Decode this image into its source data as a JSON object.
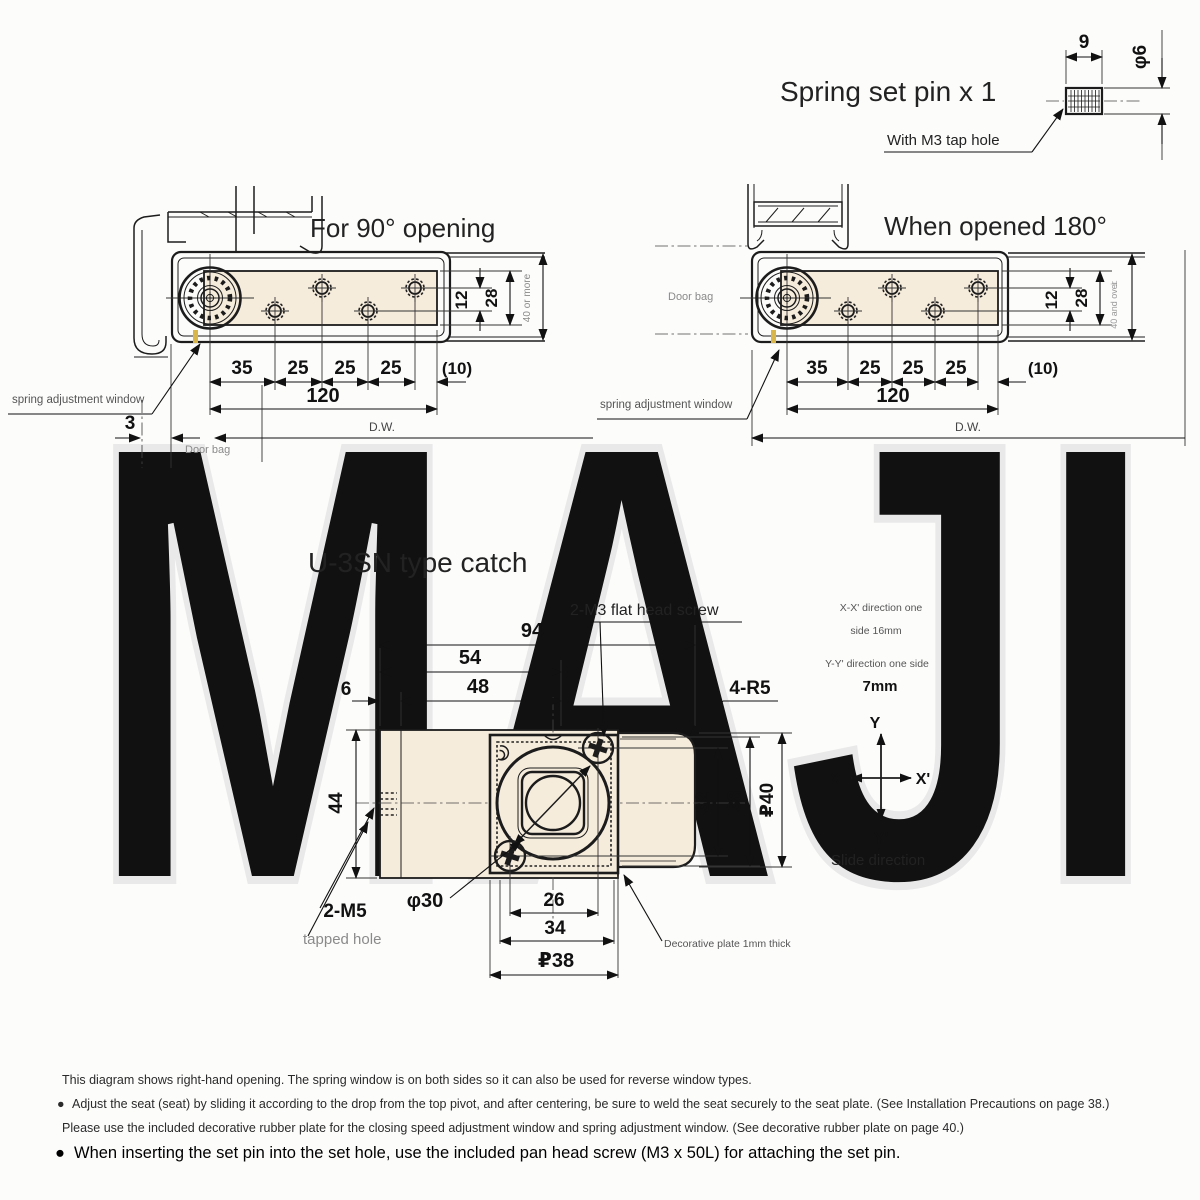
{
  "watermark": "MAJI",
  "spring_pin": {
    "title": "Spring set pin x 1",
    "note": "With M3 tap hole",
    "length": "9",
    "diameter": "φ6"
  },
  "fig_90": {
    "title": "For 90° opening",
    "chain": [
      "35",
      "25",
      "25",
      "25",
      "(10)"
    ],
    "total": "120",
    "door_width": "D.W.",
    "gap": "3",
    "door_bag": "Door bag",
    "spring_window": "spring adjustment window",
    "pitch": "12",
    "plate_width": "28",
    "clearance": "40 or more"
  },
  "fig_180": {
    "title": "When opened 180°",
    "chain": [
      "35",
      "25",
      "25",
      "25",
      "(10)"
    ],
    "total": "120",
    "door_width": "D.W.",
    "door_bag": "Door bag",
    "spring_window": "spring adjustment window",
    "pitch": "12",
    "plate_width": "28",
    "clearance": "40 and over",
    "datum_mark": "⊥"
  },
  "catch": {
    "title": "U-3SN type catch",
    "screw_label": "2-M3 flat head screw",
    "corner_radius": "4-R5",
    "w94": "94",
    "w54": "54",
    "w48": "48",
    "w6": "6",
    "h44": "44",
    "h32": "32",
    "h38": "38",
    "h40": "₽40",
    "dia30": "φ30",
    "w26": "26",
    "w34": "34",
    "w38": "₽38",
    "tap": "2-M5",
    "tap_note": "tapped hole",
    "plate_note": "Decorative plate 1mm thick",
    "xx_note_line1": "X-X' direction one",
    "xx_note_line2": "side 16mm",
    "yy_note_line1": "Y-Y' direction one side",
    "yy_note_line2": "7mm",
    "axis_y": "Y",
    "axis_x": "X",
    "axis_x_prime": "X'",
    "axis_y_prime": "Y'",
    "slide_direction": "Slide direction"
  },
  "notes": {
    "bullet": "●",
    "line1": "This diagram shows right-hand opening. The spring window is on both sides so it can also be used for reverse window types.",
    "line2": "Adjust the seat (seat) by sliding it according to the drop from the top pivot, and after centering, be sure to weld the seat securely to the seat plate. (See Installation Precautions on page 38.)",
    "line3": "Please use the included decorative rubber plate for the closing speed adjustment window and spring adjustment window. (See decorative rubber plate on page 40.)",
    "line4": "When inserting the set pin into the set hole, use the included pan head screw (M3 x 50L) for attaching the set pin."
  },
  "colors": {
    "plate_fill": "#f6ecdc",
    "line": "#1c1c1c",
    "watermark": "#e9e9e9",
    "spring_slit": "#d9b64a"
  }
}
